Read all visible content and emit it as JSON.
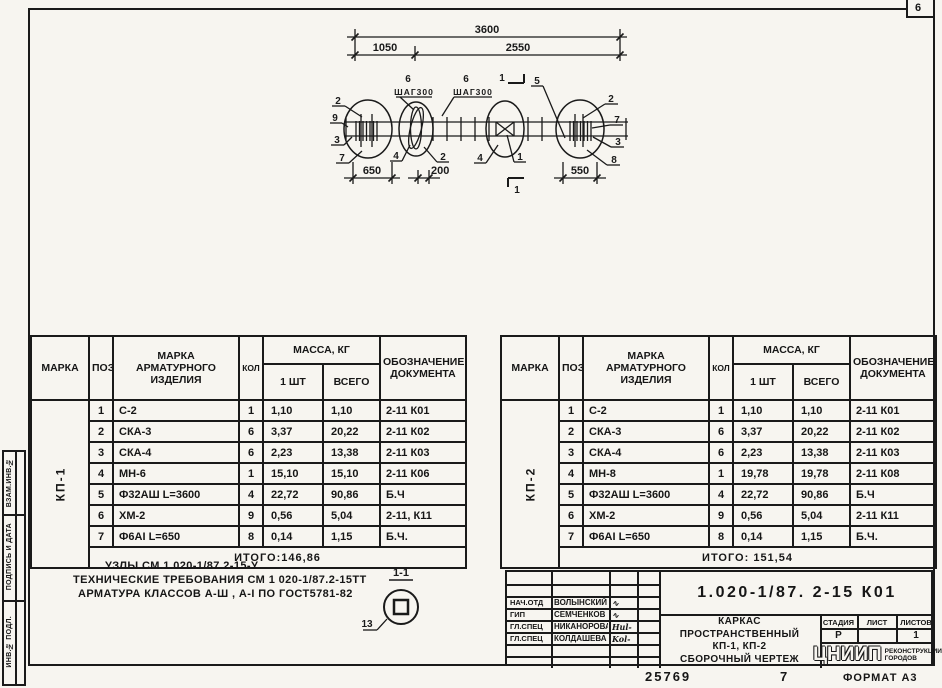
{
  "sheet": {
    "corner_mark": "6",
    "footer_code": "25769",
    "footer_number": "7",
    "footer_format": "ФОРМАТ А3"
  },
  "sidebar": {
    "items": [
      "ВЗАМ.ИНВ.№",
      "ПОДПИСЬ И ДАТА",
      "ИНВ.№ ПОДЛ."
    ]
  },
  "drawing": {
    "dim_total": "3600",
    "dim_seg1": "1050",
    "dim_seg2": "2550",
    "dim_650": "650",
    "dim_200": "200",
    "dim_550": "550",
    "shag1_pos": "6",
    "shag1": "ШАГ300",
    "shag2_pos": "6",
    "shag2": "ШАГ300",
    "section_top": "1",
    "section_bottom": "1",
    "pos5": "5",
    "callouts_left": [
      "2",
      "9",
      "3",
      "7"
    ],
    "callouts_right": [
      "2",
      "7",
      "3",
      "8"
    ],
    "callouts_bottom": [
      "4",
      "2",
      "4",
      "1"
    ]
  },
  "spec_headers": {
    "marka": "МАРКА",
    "poz": "ПОЗ.",
    "name": "МАРКА\nАРМАТУРНОГО\nИЗДЕЛИЯ",
    "qty": "КОЛ",
    "mass": "МАССА, КГ",
    "one": "1 ШТ",
    "total": "ВСЕГО",
    "doc": "ОБОЗНАЧЕНИЕ\nДОКУМЕНТА"
  },
  "tables": [
    {
      "mark": "КП-1",
      "rows": [
        {
          "poz": "1",
          "name": "С-2",
          "qty": "1",
          "one": "1,10",
          "all": "1,10",
          "doc": "2-11 К01"
        },
        {
          "poz": "2",
          "name": "СКА-3",
          "qty": "6",
          "one": "3,37",
          "all": "20,22",
          "doc": "2-11 К02"
        },
        {
          "poz": "3",
          "name": "СКА-4",
          "qty": "6",
          "one": "2,23",
          "all": "13,38",
          "doc": "2-11 К03"
        },
        {
          "poz": "4",
          "name": "МН-6",
          "qty": "1",
          "one": "15,10",
          "all": "15,10",
          "doc": "2-11 К06"
        },
        {
          "poz": "5",
          "name": "Ф32АШ L=3600",
          "qty": "4",
          "one": "22,72",
          "all": "90,86",
          "doc": "Б.Ч"
        },
        {
          "poz": "6",
          "name": "ХМ-2",
          "qty": "9",
          "one": "0,56",
          "all": "5,04",
          "doc": "2-11, К11"
        },
        {
          "poz": "7",
          "name": "Ф6АI L=650",
          "qty": "8",
          "one": "0,14",
          "all": "1,15",
          "doc": "Б.Ч."
        }
      ],
      "itogo": "ИТОГО:146,86"
    },
    {
      "mark": "КП-2",
      "rows": [
        {
          "poz": "1",
          "name": "С-2",
          "qty": "1",
          "one": "1,10",
          "all": "1,10",
          "doc": "2-11 К01"
        },
        {
          "poz": "2",
          "name": "СКА-3",
          "qty": "6",
          "one": "3,37",
          "all": "20,22",
          "doc": "2-11 К02"
        },
        {
          "poz": "3",
          "name": "СКА-4",
          "qty": "6",
          "one": "2,23",
          "all": "13,38",
          "doc": "2-11 К03"
        },
        {
          "poz": "4",
          "name": "МН-8",
          "qty": "1",
          "one": "19,78",
          "all": "19,78",
          "doc": "2-11 К08"
        },
        {
          "poz": "5",
          "name": "Ф32АШ L=3600",
          "qty": "4",
          "one": "22,72",
          "all": "90,86",
          "doc": "Б.Ч"
        },
        {
          "poz": "6",
          "name": "ХМ-2",
          "qty": "9",
          "one": "0,56",
          "all": "5,04",
          "doc": "2-11 К11"
        },
        {
          "poz": "7",
          "name": "Ф6АI L=650",
          "qty": "8",
          "one": "0,14",
          "all": "1,15",
          "doc": "Б.Ч."
        }
      ],
      "itogo": "ИТОГО: 151,54"
    }
  ],
  "notes": [
    "УЗЛЫ СМ.1.020-1/87.2-15-У",
    "ТЕХНИЧЕСКИЕ ТРЕБОВАНИЯ СМ 1 020-1/87.2-15ТТ",
    "АРМАТУРА КЛАССОВ А-Ш , А-I ПО ГОСТ5781-82"
  ],
  "detail": {
    "title": "1-1",
    "callout": "13"
  },
  "titleblock": {
    "doc_number": "1.020-1/87. 2-15 К01",
    "signers": [
      {
        "role": "НАЧ.ОТД",
        "name": "ВОЛЫНСКИЙ",
        "sig": "∿"
      },
      {
        "role": "ГИП",
        "name": "СЕМЧЕНКОВ",
        "sig": "∿"
      },
      {
        "role": "ГЛ.СПЕЦ",
        "name": "НИКАНОРОВА",
        "sig": "Hul-"
      },
      {
        "role": "ГЛ.СПЕЦ",
        "name": "КОЛДАШЕВА",
        "sig": "Kol-"
      }
    ],
    "title_lines": [
      "КАРКАС",
      "ПРОСТРАНСТВЕННЫЙ",
      "КП-1, КП-2",
      "СБОРОЧНЫЙ ЧЕРТЕЖ"
    ],
    "stage_label": "СТАДИЯ",
    "sheet_label": "ЛИСТ",
    "sheets_label": "ЛИСТОВ",
    "stage": "Р",
    "sheet": "",
    "sheets": "1",
    "org_abbr": "ЦНИИП",
    "org_line1": "РЕКОНСТРУКЦИИ",
    "org_line2": "ГОРОДОВ"
  }
}
